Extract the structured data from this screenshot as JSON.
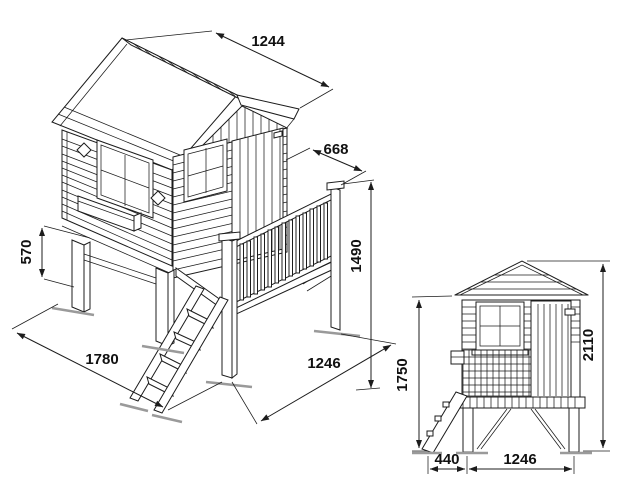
{
  "colors": {
    "background": "#ffffff",
    "line": "#1c1c1c",
    "ground_marks": "#9a9a9a",
    "label_text": "#111111"
  },
  "views": {
    "isometric": {
      "description": "Perspective view of stilted playhouse with porch railing and ladder",
      "dims": {
        "roof_length": "1244",
        "porch_depth": "668",
        "post_height": "1490",
        "stilt_height": "570",
        "footprint_depth": "1780",
        "footprint_width": "1246"
      }
    },
    "front": {
      "description": "Front elevation of playhouse",
      "dims": {
        "eave_height": "1750",
        "total_height": "2110",
        "ladder_depth": "440",
        "body_width": "1246"
      }
    }
  }
}
